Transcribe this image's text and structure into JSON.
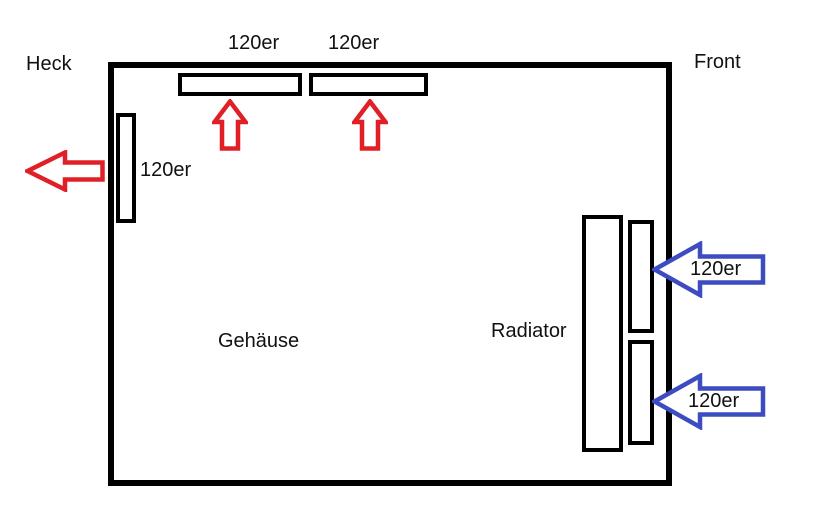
{
  "case": {
    "heck_label": "Heck",
    "front_label": "Front",
    "gehaeuse_label": "Gehäuse"
  },
  "top_fans": [
    {
      "label": "120er",
      "airflow": "exhaust-up"
    },
    {
      "label": "120er",
      "airflow": "exhaust-up"
    }
  ],
  "rear_fan": {
    "label": "120er",
    "airflow": "exhaust-left"
  },
  "radiator": {
    "label": "Radiator",
    "fans": [
      {
        "label": "120er",
        "airflow": "intake-left"
      },
      {
        "label": "120er",
        "airflow": "intake-left"
      }
    ]
  },
  "colors": {
    "outline": "#000000",
    "exhaust_arrow": "#e02026",
    "intake_arrow": "#3e4cc1"
  }
}
